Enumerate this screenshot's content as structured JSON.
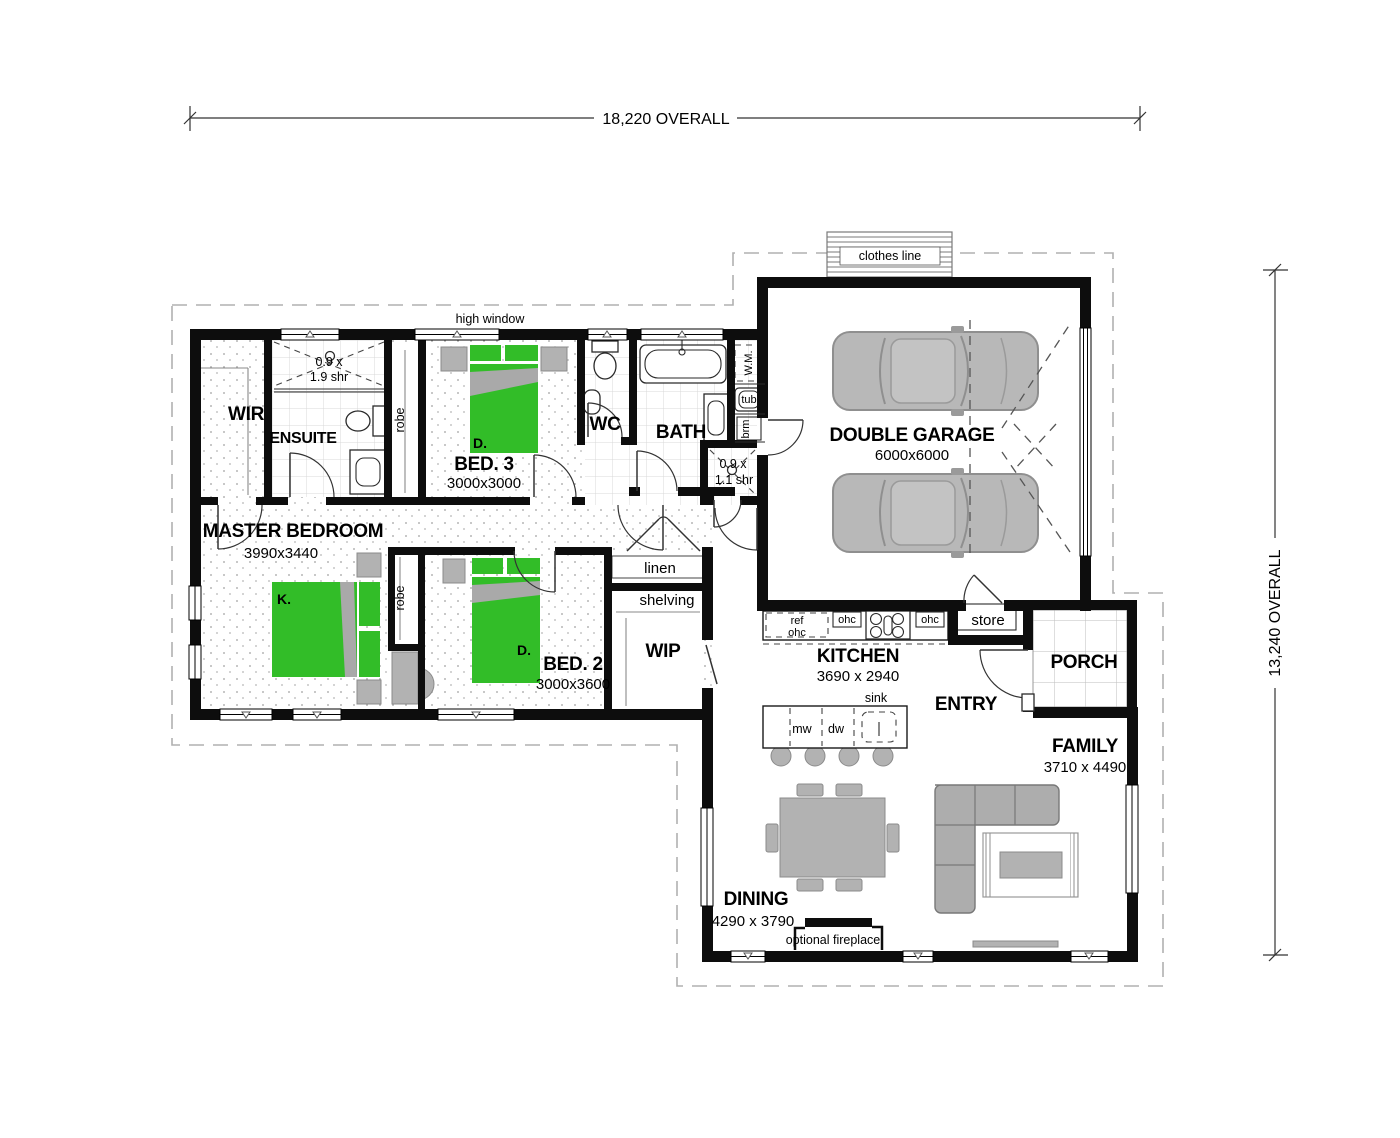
{
  "drawing": {
    "dimensions": {
      "top": "18,220 OVERALL",
      "right": "13,240 OVERALL"
    },
    "rooms": {
      "wir": {
        "name": "WIR"
      },
      "ensuite": {
        "name": "ENSUITE"
      },
      "bed3": {
        "name": "BED. 3",
        "size": "3000x3000"
      },
      "wc": {
        "name": "WC"
      },
      "bath": {
        "name": "BATH"
      },
      "garage": {
        "name": "DOUBLE GARAGE",
        "size": "6000x6000"
      },
      "master": {
        "name": "MASTER BEDROOM",
        "size": "3990x3440"
      },
      "bed2": {
        "name": "BED. 2",
        "size": "3000x3600"
      },
      "wip": {
        "name": "WIP"
      },
      "kitchen": {
        "name": "KITCHEN",
        "size": "3690 x 2940"
      },
      "entry": {
        "name": "ENTRY"
      },
      "porch": {
        "name": "PORCH"
      },
      "family": {
        "name": "FAMILY",
        "size": "3710 x 4490"
      },
      "dining": {
        "name": "DINING",
        "size": "4290 x 3790"
      }
    },
    "labels": {
      "clothes_line": "clothes line",
      "high_window": "high window",
      "robe": "robe",
      "linen": "linen",
      "shelving": "shelving",
      "store": "store",
      "wm": "W.M.",
      "tub": "tub",
      "brm": "brm",
      "ref": "ref",
      "ohc": "ohc",
      "mw": "mw",
      "dw": "dw",
      "sink": "sink",
      "fireplace": "optional fireplace",
      "bed_king": "K.",
      "bed_double": "D.",
      "shower_ensuite_l1": "0.9 x",
      "shower_ensuite_l2": "1.9 shr",
      "shower_bath_l1": "0.9 x",
      "shower_bath_l2": "1.1 shr"
    },
    "colors": {
      "wall": "#0d0d0d",
      "bed_green": "#32bd28",
      "furniture_gray": "#b2b2b2",
      "car_gray": "#b8b8b8",
      "tile_line": "#d8d8d8",
      "eaves_dash": "#b0b0b0"
    }
  }
}
